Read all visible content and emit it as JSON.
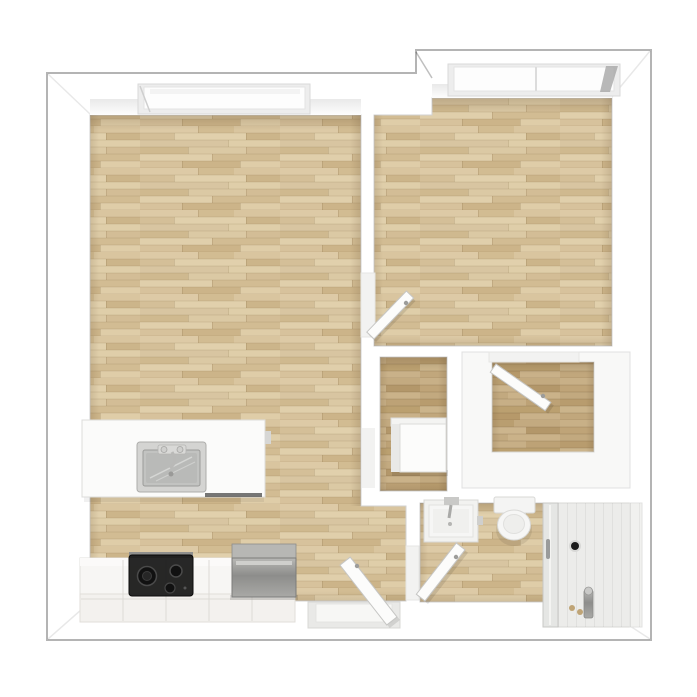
{
  "plan": {
    "type": "apartment-floor-plan",
    "view": "top-down 3d render",
    "width_px": 697,
    "height_px": 697
  },
  "colors": {
    "background": "#ffffff",
    "outline": "#b4b4b4",
    "wall": "#fdfdfd",
    "wall_shade": "#ececec",
    "wood_base": "#d9c5a0",
    "wood_dark_base": "#c2a87e",
    "threshold": "#f2f2f1",
    "island_white": "#fbfbfa",
    "counter_white": "#f7f6f4",
    "cabinet_front": "#f3f1ee",
    "cooktop_black": "#1c1c1c",
    "steel": "#9d9d9a",
    "steel_light": "#c9c9c7",
    "sink_steel": "#c2c3c1",
    "fixture_white": "#f6f6f5",
    "shower_floor": "#ececea",
    "glass": "#e4e5e3",
    "brass": "#bfa476",
    "door_white": "#fcfcfb",
    "closet_unit_white": "#f8f8f7",
    "heater_white": "#fcfcfb",
    "drain_black": "#1a1a1a"
  },
  "rooms": [
    {
      "id": "living-kitchen",
      "label": "Living room with open kitchen",
      "floor": "light oak plank"
    },
    {
      "id": "bedroom",
      "label": "Bedroom",
      "floor": "light oak plank"
    },
    {
      "id": "storage",
      "label": "Storage / utility room",
      "floor": "dark oak plank"
    },
    {
      "id": "walk-in-closet",
      "label": "Walk-in closet",
      "floor": "dark oak plank with white wardrobe units"
    },
    {
      "id": "bathroom",
      "label": "Bathroom",
      "floor": "light oak plank"
    },
    {
      "id": "shower",
      "label": "Shower enclosure",
      "floor": "white panel floor"
    }
  ],
  "fixtures": {
    "living_window": "recessed window, top wall of living room",
    "bedroom_window": "recessed window, top wall of bedroom",
    "kitchen_island": "white island counter with stainless sink and faucet",
    "base_cabinets": "white base cabinet run along bottom wall",
    "cooktop": "black cooktop with burners",
    "oven": "stainless steel oven / appliance",
    "water_heater": "white water-heater cabinet in storage room",
    "wardrobe_units": "white wardrobe units lining walk-in closet",
    "washbasin": "square white washbasin with faucet",
    "toilet": "toilet with tank",
    "shower_glass": "glass shower door with handle",
    "shower_drain": "floor drain",
    "shower_tap": "brass shower fixture"
  },
  "doors": [
    {
      "id": "entrance-door",
      "label": "Apartment entrance door, bottom wall, opens into living room"
    },
    {
      "id": "bedroom-door",
      "label": "Bedroom door, opens into bedroom"
    },
    {
      "id": "closet-door",
      "label": "Walk-in closet door, opens into closet"
    },
    {
      "id": "bathroom-door",
      "label": "Bathroom door, opens into bathroom"
    }
  ]
}
